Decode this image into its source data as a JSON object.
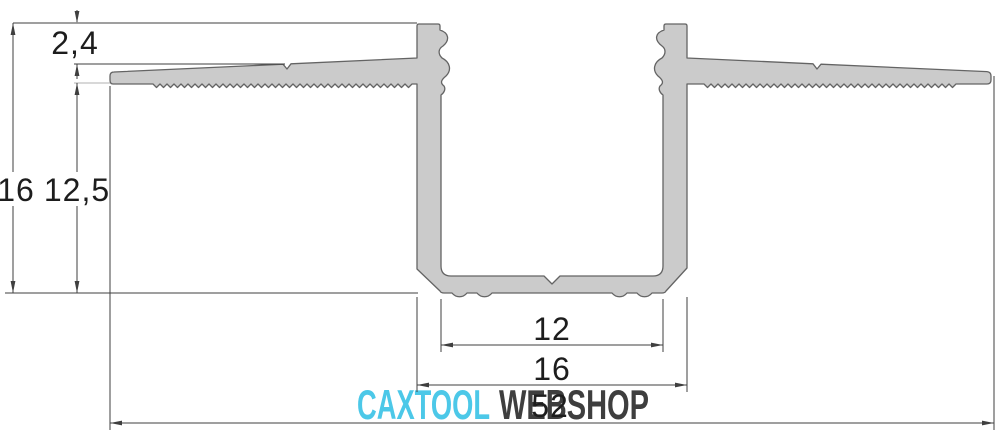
{
  "dims": {
    "flange_step": "2,4",
    "total_height": "16",
    "recess_depth": "12,5",
    "inner_width": "12",
    "base_width": "16",
    "overall_width": "52"
  },
  "watermark": {
    "brand": "CAXTOOL",
    "suffix": "WEBSHOP"
  },
  "colors": {
    "background": "#ffffff",
    "profile_fill": "#cbcbcb",
    "profile_stroke": "#646464",
    "dim_line": "#3f3f3f",
    "ext_line_gray": "#b0b0b0",
    "dim_text": "#1d1d1d",
    "watermark_cyan": "#4cc8e8",
    "watermark_dark": "#3e3e3e"
  }
}
